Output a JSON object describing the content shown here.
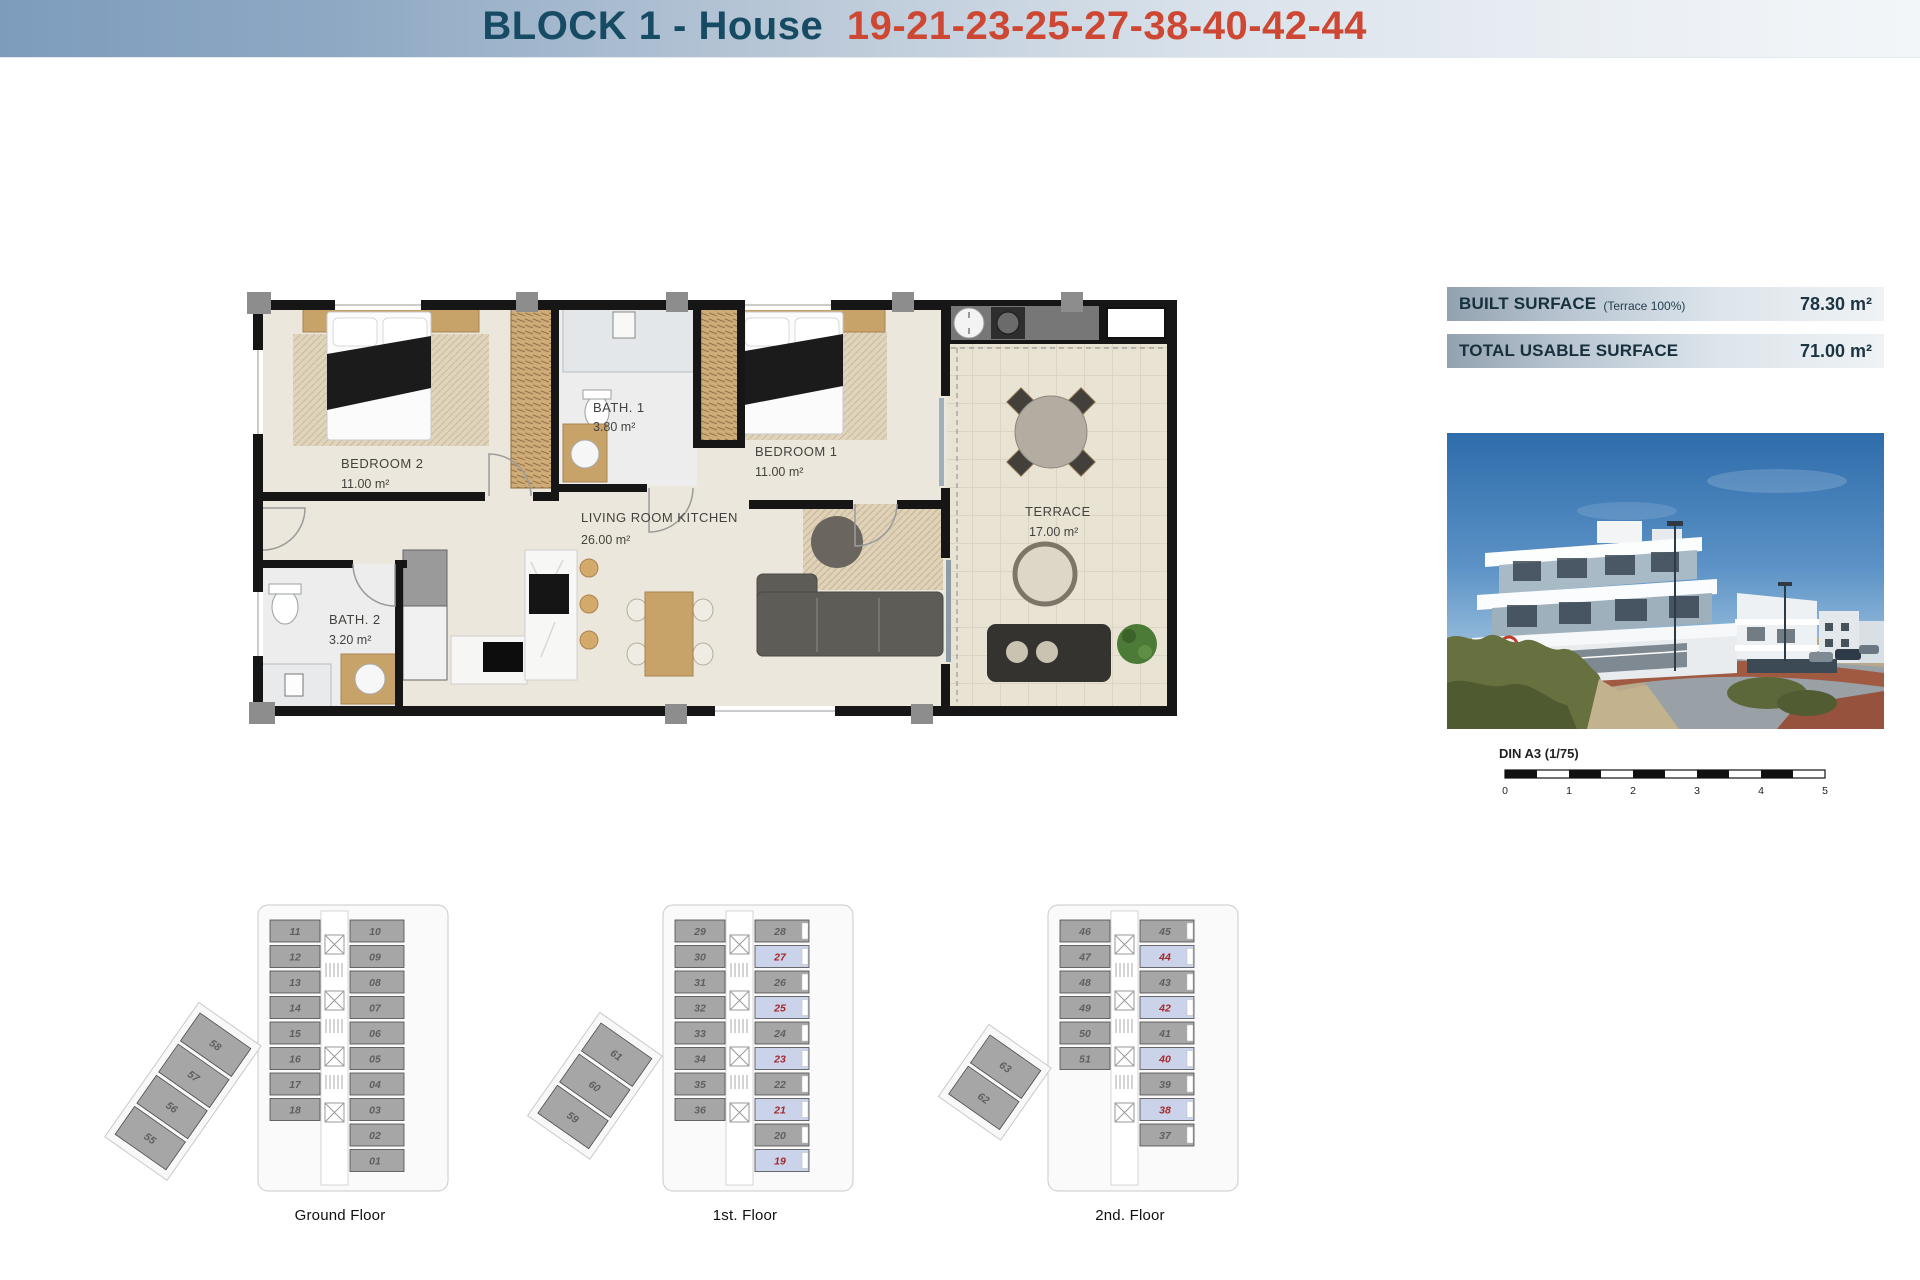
{
  "header": {
    "title_prefix": "BLOCK 1 - House",
    "title_numbers": "19-21-23-25-27-38-40-42-44"
  },
  "surface_panel": {
    "rows": [
      {
        "label": "BUILT SURFACE",
        "note": "(Terrace 100%)",
        "value": "78.30 m²"
      },
      {
        "label": "TOTAL USABLE SURFACE",
        "note": "",
        "value": "71.00 m²"
      }
    ]
  },
  "floor_plan": {
    "rooms": [
      {
        "name": "BEDROOM 2",
        "area": "11.00 m²"
      },
      {
        "name": "BATH. 1",
        "area": "3.80 m²"
      },
      {
        "name": "BEDROOM 1",
        "area": "11.00 m²"
      },
      {
        "name": "LIVING ROOM KITCHEN",
        "area": "26.00 m²"
      },
      {
        "name": "BATH. 2",
        "area": "3.20 m²"
      },
      {
        "name": "TERRACE",
        "area": "17.00 m²"
      }
    ]
  },
  "scale_bar": {
    "label": "DIN A3 (1/75)",
    "ticks": [
      "0",
      "1",
      "2",
      "3",
      "4",
      "5"
    ]
  },
  "floors": [
    {
      "label": "Ground Floor",
      "left": [
        "11",
        "12",
        "13",
        "14",
        "15",
        "16",
        "17",
        "18"
      ],
      "right": [
        {
          "n": "10"
        },
        {
          "n": "09"
        },
        {
          "n": "08"
        },
        {
          "n": "07"
        },
        {
          "n": "06"
        },
        {
          "n": "05"
        },
        {
          "n": "04"
        },
        {
          "n": "03"
        },
        {
          "n": "02"
        },
        {
          "n": "01"
        }
      ],
      "diag": [
        "58",
        "57",
        "56",
        "55"
      ]
    },
    {
      "label": "1st. Floor",
      "left": [
        "29",
        "30",
        "31",
        "32",
        "33",
        "34",
        "35",
        "36"
      ],
      "right": [
        {
          "n": "28"
        },
        {
          "n": "27",
          "hl": true
        },
        {
          "n": "26"
        },
        {
          "n": "25",
          "hl": true
        },
        {
          "n": "24"
        },
        {
          "n": "23",
          "hl": true
        },
        {
          "n": "22"
        },
        {
          "n": "21",
          "hl": true
        },
        {
          "n": "20"
        },
        {
          "n": "19",
          "hl": true
        }
      ],
      "diag": [
        "61",
        "60",
        "59"
      ]
    },
    {
      "label": "2nd. Floor",
      "left": [
        "46",
        "47",
        "48",
        "49",
        "50",
        "51"
      ],
      "right": [
        {
          "n": "45"
        },
        {
          "n": "44",
          "hl": true
        },
        {
          "n": "43"
        },
        {
          "n": "42",
          "hl": true
        },
        {
          "n": "41"
        },
        {
          "n": "40",
          "hl": true
        },
        {
          "n": "39"
        },
        {
          "n": "38",
          "hl": true
        },
        {
          "n": "37"
        }
      ],
      "diag": [
        "63",
        "62"
      ]
    }
  ],
  "colors": {
    "title_navy": "#174a63",
    "title_red": "#cd4732",
    "banner_text": "#16303c",
    "unit_gray": "#a6a6a6",
    "unit_num": "#5f5f5f",
    "hl_bg": "#cbd3ea",
    "hl_num": "#a2282b"
  }
}
